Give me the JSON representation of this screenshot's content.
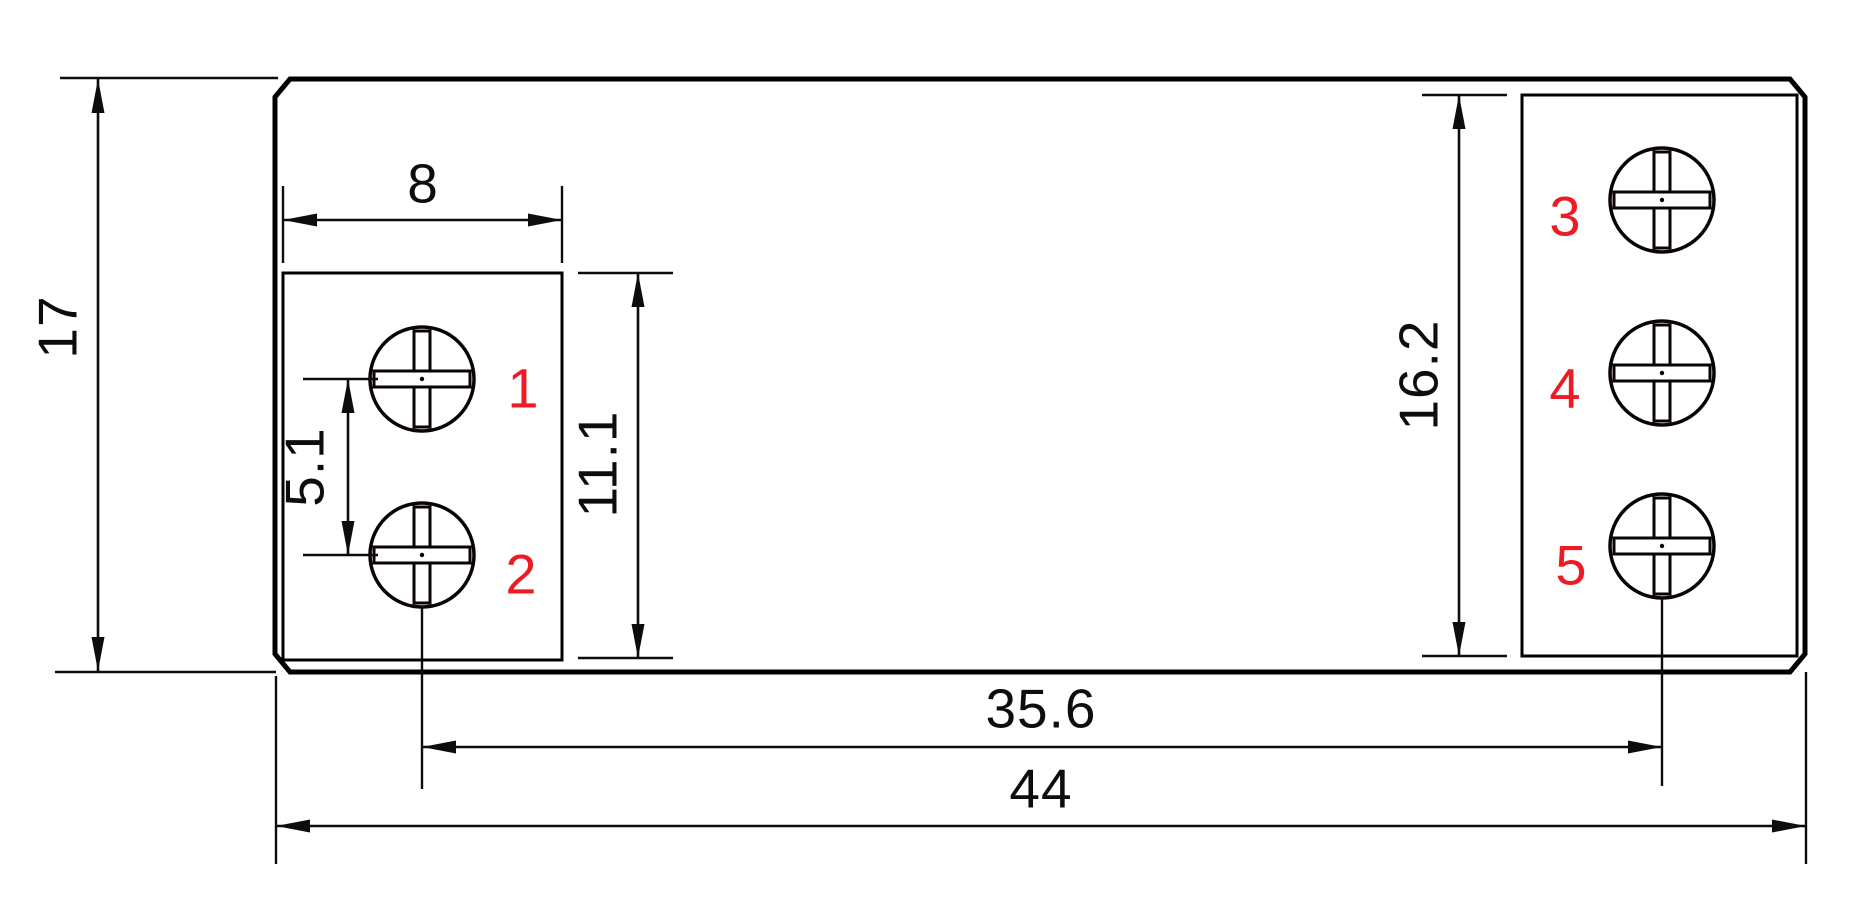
{
  "drawing": {
    "kind": "technical-dimension-drawing",
    "view": "front-face of 5-terminal module with two screw-terminal recesses"
  },
  "dimensions": {
    "overall_height": "17",
    "overall_width": "44",
    "left_block_width": "8",
    "left_block_height": "11.1",
    "left_screw_pitch": "5.1",
    "right_block_height": "16.2",
    "screw_column_span": "35.6"
  },
  "terminals": {
    "labels": [
      "1",
      "2",
      "3",
      "4",
      "5"
    ]
  },
  "colors": {
    "line": "#0d0d0d",
    "terminal_label": "#ed1c24",
    "background": "#ffffff"
  }
}
